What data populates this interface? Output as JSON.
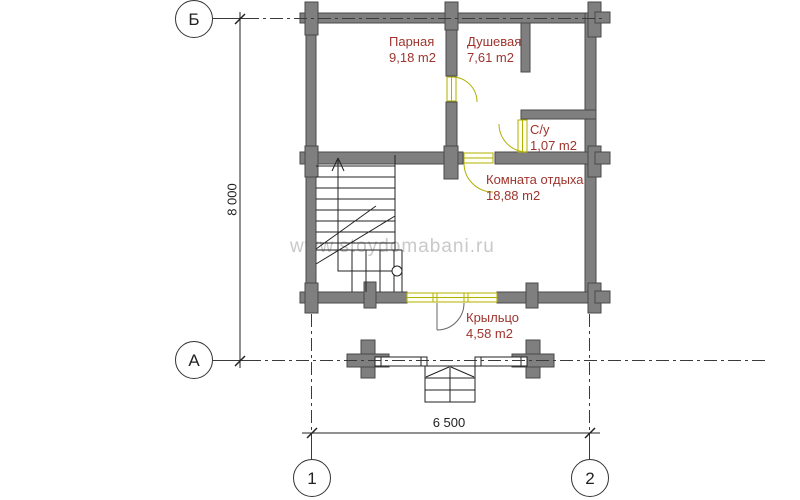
{
  "watermark": "www.stoydomabani.ru",
  "rooms": [
    {
      "name": "Парная",
      "area": "9,18 m2"
    },
    {
      "name": "Душевая",
      "area": "7,61 m2"
    },
    {
      "name": "С/у",
      "area": "1,07 m2"
    },
    {
      "name": "Комната отдыха",
      "area": "18,88 m2"
    },
    {
      "name": "Крыльцо",
      "area": "4,58 m2"
    }
  ],
  "axis_markers": {
    "row_top": "Б",
    "row_bottom": "А",
    "col_left": "1",
    "col_right": "2"
  },
  "dimensions": {
    "height_total": "8 000",
    "width_total": "6 500"
  },
  "colors": {
    "wall": "#7f7f7f",
    "wall_edge": "#4a4a4a",
    "door": "#b0b000",
    "label_red": "#9e342d",
    "watermark_gray": "#c9c9c9"
  }
}
